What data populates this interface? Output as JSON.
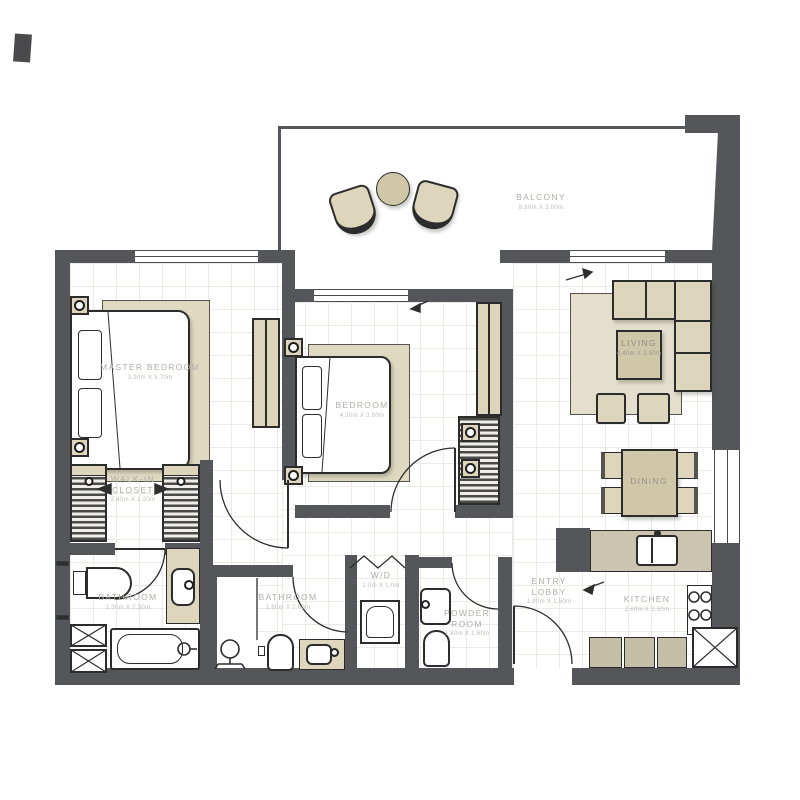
{
  "plan_title": "apartment-floor-plan",
  "colors": {
    "wall": "#55565A",
    "furniture_beige": "#DDD6BD",
    "table_beige": "#CFC7A8",
    "rug_beige": "#DFD9C2",
    "outline": "#2C2C2C",
    "label_text": "#B0ADA7",
    "grid_line": "#ECEAE6"
  },
  "rooms": {
    "master_bedroom": {
      "name": "MASTER BEDROOM",
      "dims": "3.90m X 3.70m"
    },
    "bedroom": {
      "name": "BEDROOM",
      "dims": "4.30m X 3.60m"
    },
    "balcony": {
      "name": "BALCONY",
      "dims": "8.60m X 3.00m"
    },
    "living": {
      "name": "LIVING",
      "dims": "4.40m X 3.90m"
    },
    "dining": {
      "name": "DINING"
    },
    "walk_in_closet": {
      "name": "WALK-IN CLOSET",
      "dims": "2.40m X 1.20m"
    },
    "bathroom_master": {
      "name": "BATHROOM",
      "dims": "2.30m X 2.30m"
    },
    "bathroom": {
      "name": "BATHROOM",
      "dims": "1.80m X 2.60m"
    },
    "wd": {
      "name": "W/D",
      "dims": "1.0m X 1.0m"
    },
    "powder_room": {
      "name": "POWDER ROOM",
      "dims": "1.80m X 1.60m"
    },
    "entry_lobby": {
      "name": "ENTRY LOBBY",
      "dims": "1.90m X 1.50m"
    },
    "kitchen": {
      "name": "KITCHEN",
      "dims": "2.60m X 2.50m"
    }
  }
}
